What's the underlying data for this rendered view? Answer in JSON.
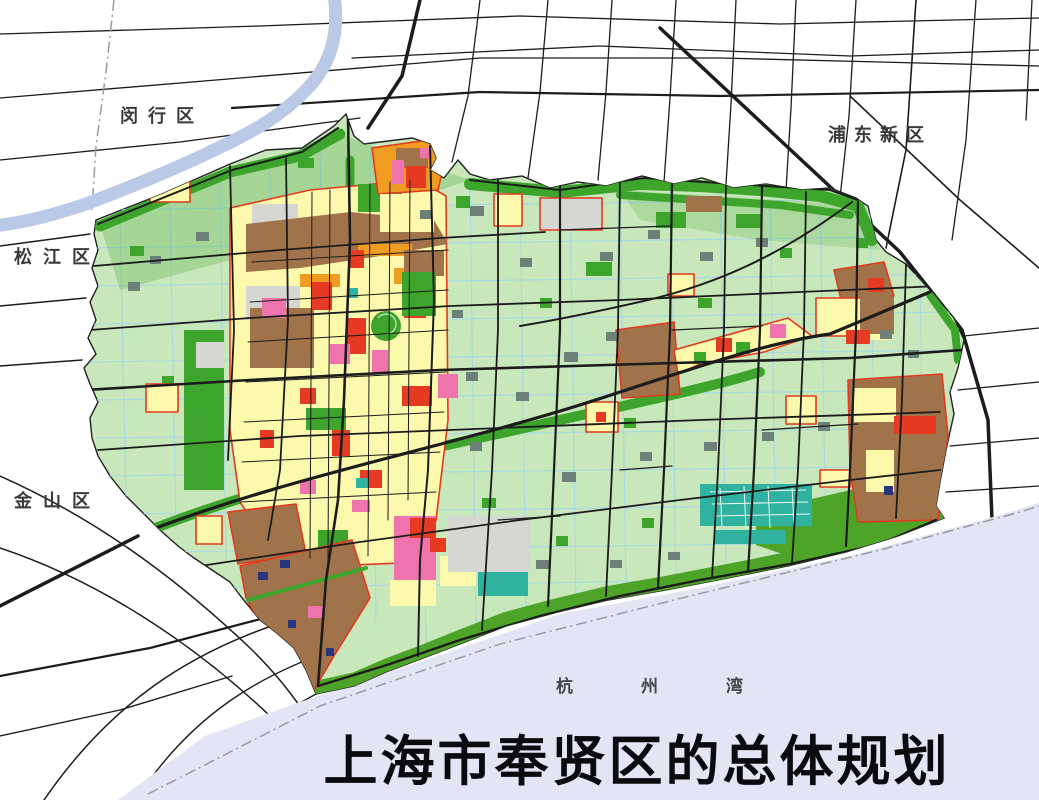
{
  "map": {
    "title": "上海市奉贤区的总体规划",
    "district_shown": "奉贤区",
    "labels": {
      "minhang": "闵行区",
      "pudong": "浦东新区",
      "songjiang": "松江区",
      "jinshan": "金山区",
      "bay": "杭州湾"
    }
  },
  "palette": {
    "farmland": "#c8e7ba",
    "park_green": "#3ea52c",
    "coastal_green": "#4da428",
    "residential_yellow": "#fcf9ac",
    "industrial_brown": "#a1734b",
    "commercial_red": "#e63a23",
    "public_pink": "#ef74ad",
    "mixed_orange": "#f09b21",
    "reserve_gray": "#d6d6d2",
    "village_gray": "#6d8078",
    "special_teal": "#2fb2a0",
    "river_blue": "#b9c9e6",
    "canal_blue": "#a9d8e6",
    "bay_lavender": "#e3e4f4",
    "road_black": "#1c1c1c",
    "boundary_red": "#e23a1e",
    "label_gray": "#3a3a3a",
    "title_black": "#0a0a10"
  }
}
